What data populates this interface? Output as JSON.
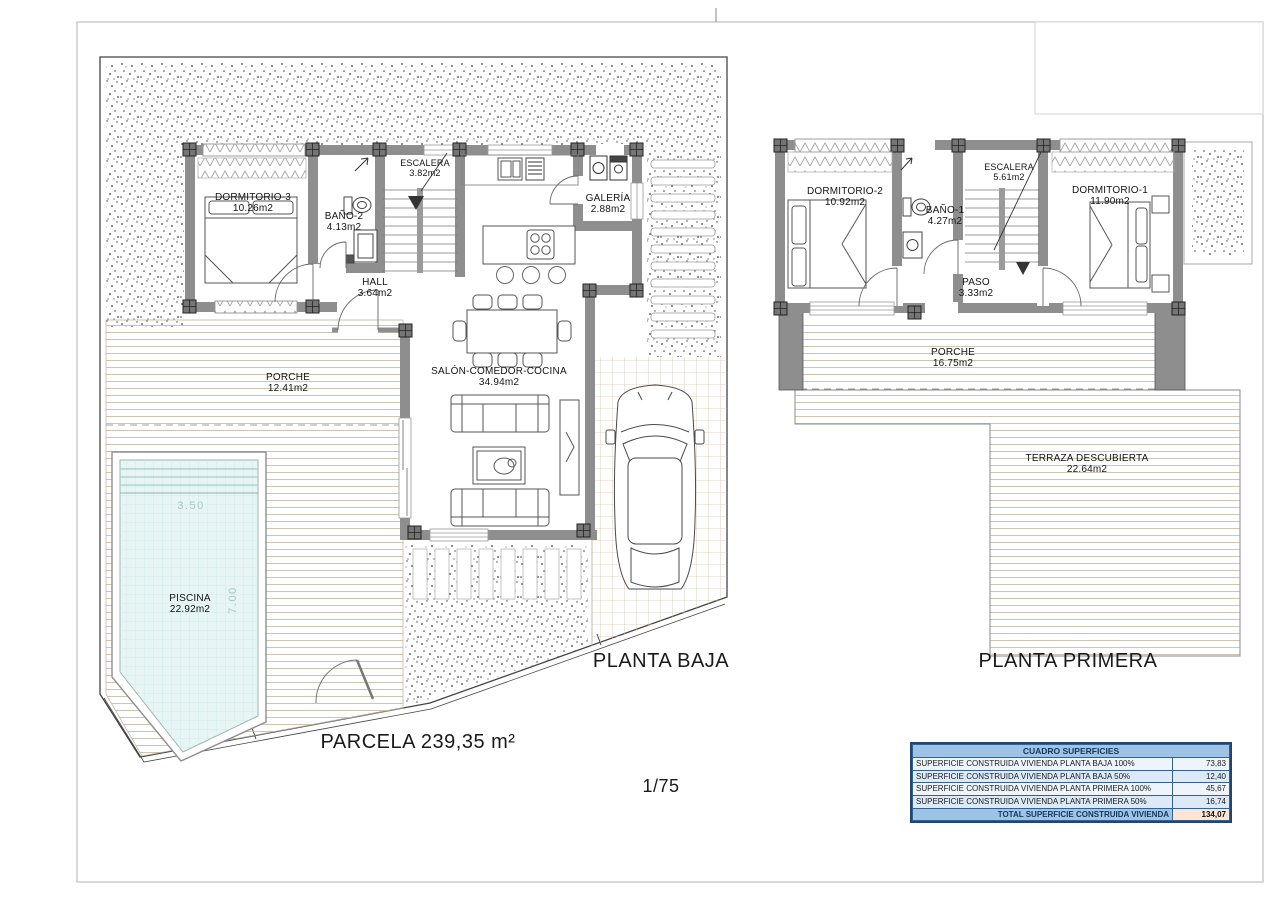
{
  "page": {
    "parcel_label": "PARCELA 239,35 m²",
    "scale_label": "1/75"
  },
  "floors": {
    "baja": {
      "title": "PLANTA BAJA",
      "rooms": [
        {
          "name": "DORMITORIO-3",
          "area": "10.26m2"
        },
        {
          "name": "BAÑO-2",
          "area": "4.13m2"
        },
        {
          "name": "ESCALERA",
          "area": "3.82m2"
        },
        {
          "name": "HALL",
          "area": "3.64m2"
        },
        {
          "name": "GALERÍA",
          "area": "2.88m2"
        },
        {
          "name": "SALÓN-COMEDOR-COCINA",
          "area": "34.94m2"
        },
        {
          "name": "PORCHE",
          "area": "12.41m2"
        },
        {
          "name": "PISCINA",
          "area": "22.92m2"
        }
      ],
      "pool_dimensions": {
        "width": "3.50",
        "length": "7.00"
      }
    },
    "primera": {
      "title": "PLANTA PRIMERA",
      "rooms": [
        {
          "name": "DORMITORIO-2",
          "area": "10.92m2"
        },
        {
          "name": "BAÑO-1",
          "area": "4.27m2"
        },
        {
          "name": "ESCALERA",
          "area": "5.61m2"
        },
        {
          "name": "DORMITORIO-1",
          "area": "11.90m2"
        },
        {
          "name": "PASO",
          "area": "3.33m2"
        },
        {
          "name": "PORCHE",
          "area": "16.75m2"
        },
        {
          "name": "TERRAZA DESCUBIERTA",
          "area": "22.64m2"
        }
      ]
    }
  },
  "surfaces_table": {
    "title": "CUADRO SUPERFICIES",
    "rows": [
      {
        "label": "SUPERFICIE CONSTRUIDA VIVIENDA PLANTA BAJA 100%",
        "value": "73,83"
      },
      {
        "label": "SUPERFICIE CONSTRUIDA VIVIENDA PLANTA BAJA 50%",
        "value": "12,40"
      },
      {
        "label": "SUPERFICIE CONSTRUIDA VIVIENDA PLANTA PRIMERA 100%",
        "value": "45,67"
      },
      {
        "label": "SUPERFICIE CONSTRUIDA VIVIENDA PLANTA PRIMERA 50%",
        "value": "16,74"
      }
    ],
    "total": {
      "label": "TOTAL SUPERFICIE CONSTRUIDA VIVIENDA",
      "value": "134,07"
    },
    "colors": {
      "header_bg": "#9DC3E6",
      "row_alt_bg": "#DCE9F6",
      "row_bg": "#EEF4FB",
      "total_value_bg": "#FBE5D6",
      "border": "#24456E",
      "wall_gray": "#8E8E8E",
      "pool_water": "#E7F6F5"
    }
  }
}
